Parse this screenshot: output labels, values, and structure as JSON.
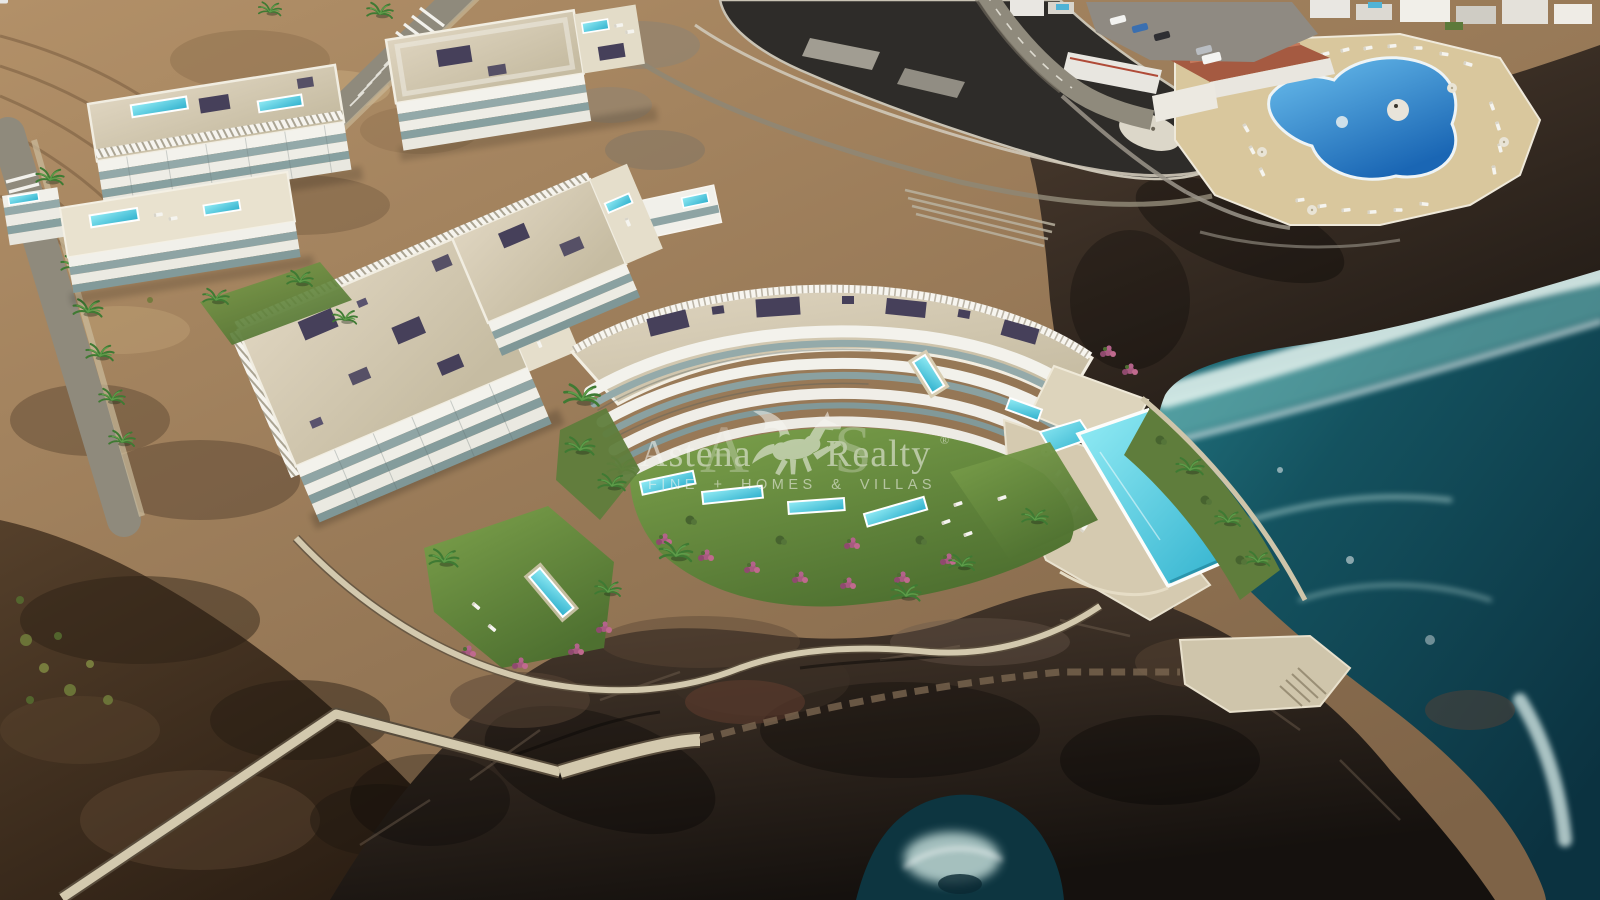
{
  "meta": {
    "type": "aerial real-estate 3d render photograph",
    "subject": "Modern clifftop apartment complex with terrace pools and a communal infinity pool on a volcanic ocean shoreline, next to an existing resort with a round swimming pool",
    "interactive_ui": false
  },
  "watermark": {
    "brand_left": "Astena",
    "brand_right": "Realty",
    "registered_mark": "®",
    "monogram_left": "A",
    "monogram_right": "S",
    "tagline": "FINE + HOMES & VILLAS",
    "logo_icon": "pegasus-icon",
    "color": "#f7f6f1"
  },
  "scene": {
    "features": [
      "terraced dirt slopes",
      "access road with zebra crossing and parking bays",
      "palm-lined street",
      "white apartment blocks with beige roofs and solar panels",
      "rooftop and terrace plunge pools",
      "landscaped lawns with sun loungers and pink flower beds",
      "long communal infinity pool",
      "seafront lagoon platform under construction",
      "neighbouring resort with round blue pool and sun loungers",
      "car park with vehicles",
      "coastal promenade wall and viewpoint stairs",
      "black volcanic rock coastline",
      "ocean surf with white foam"
    ]
  },
  "colors": {
    "dirt_light": "#b29068",
    "dirt_dark": "#7e6347",
    "soil_brown": "#55402b",
    "soil_black": "#2b1e13",
    "ocean_teal": "#2a8791",
    "ocean_mid": "#14525f",
    "ocean_deep": "#0b3240",
    "surf_foam": "#dff3ee",
    "rock_brown": "#4d3d30",
    "rock_dark": "#15110e",
    "pool_light": "#93ecf5",
    "pool_turquoise": "#2fb0cd",
    "resort_pool_light": "#6cc0ee",
    "resort_pool_blue": "#1a66b4",
    "lawn_light": "#7da24c",
    "lawn_dark": "#4e7030",
    "roof_light": "#ded4bf",
    "roof_dark": "#c6bca2",
    "facade_white": "#f3f2ec",
    "glass_teal": "#93a9a9",
    "solar_panel": "#46405a",
    "path_sand": "#d3c9ae",
    "asphalt": "#8f8a7c",
    "flower_pink": "#a85a80",
    "terracotta_roof": "#a55a41",
    "lagoon_black": "#2e2c29",
    "palm_green": "#3f7a33"
  }
}
